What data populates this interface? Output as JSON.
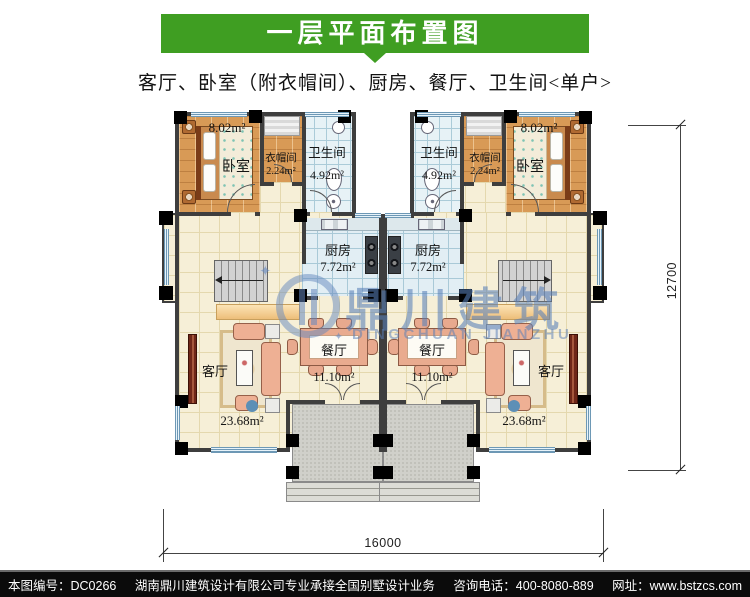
{
  "header": {
    "title": "一层平面布置图",
    "subtitle": "客厅、卧室（附衣帽间）、厨房、餐厅、卫生间<单户>"
  },
  "rooms": {
    "bedroom": {
      "name": "卧室",
      "area": "8.02m²"
    },
    "cloakroom": {
      "name": "衣帽间",
      "area": "2.24m²"
    },
    "bathroom": {
      "name": "卫生间",
      "area": "4.92m²"
    },
    "kitchen": {
      "name": "厨房",
      "area": "7.72m²"
    },
    "dining": {
      "name": "餐厅",
      "area": "11.10m²"
    },
    "living": {
      "name": "客厅",
      "area": "23.68m²"
    }
  },
  "dimensions": {
    "bottom": "16000",
    "right": "12700"
  },
  "watermark": {
    "cn": "鼎川建筑",
    "en": "DINGCHUAN JIANZHU"
  },
  "footer": {
    "number": "本图编号：DC0266",
    "company": "湖南鼎川建筑设计有限公司专业承接全国别墅设计业务",
    "phone": "咨询电话：400-8080-889",
    "site": "网址：www.bstzcs.com"
  },
  "colors": {
    "header_green": "#3f9e22",
    "watermark_blue": "#587fb9",
    "wall": "#3e3e3e"
  }
}
